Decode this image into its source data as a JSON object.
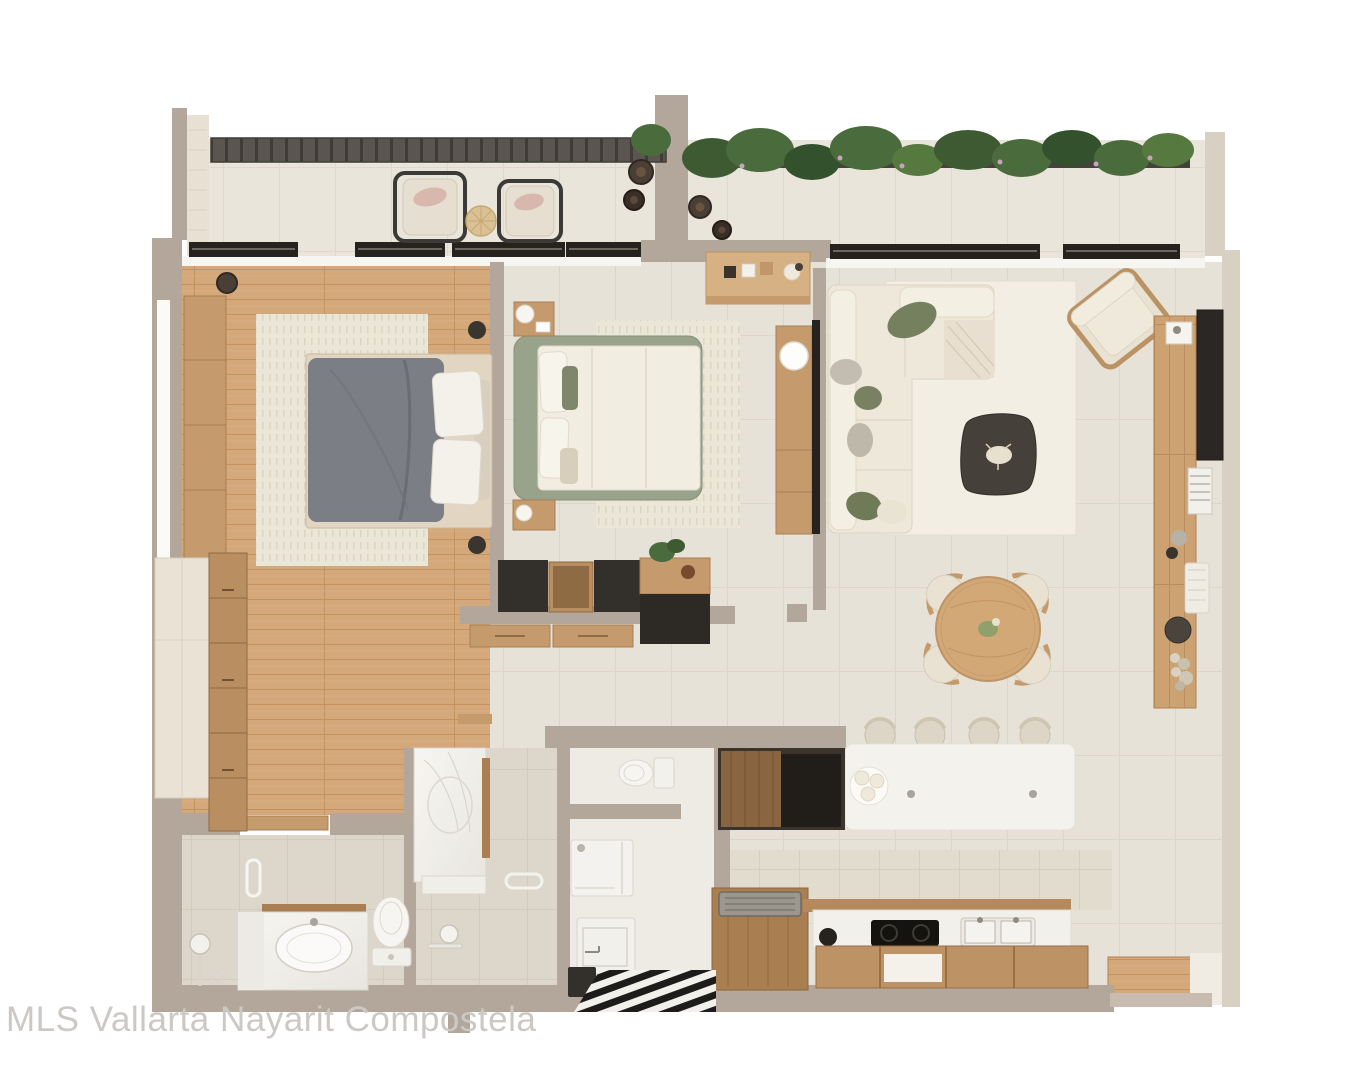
{
  "watermark": {
    "text": "MLS Vallarta Nayarit Compostela"
  },
  "palette": {
    "wall": "#b3a79b",
    "wallLight": "#c8bcb0",
    "wallCream": "#d8d0c3",
    "sill": "#f7f5f1",
    "tile": "#e7e2d7",
    "tileTerrace": "#eae5db",
    "tileBath": "#ddd7cb",
    "laundryFloor": "#edebe4",
    "wood": "#d4a87b",
    "woodFurniture": "#c59b6d",
    "woodDark": "#8a6541",
    "dark": "#332f2a",
    "black": "#26231f",
    "pergola": "#55524c",
    "planter": "#45413b",
    "greenery": "#4a6b3c",
    "flowerPink": "#c9a3bd",
    "sofaCream": "#eee8da",
    "sage": "#7f866b",
    "bedFrameSage": "#99a38b",
    "duvetGray": "#7b7e84",
    "rug": "#eae6d8",
    "island": "#f4f2ed",
    "watermarkColor": "#cbc8c5"
  }
}
